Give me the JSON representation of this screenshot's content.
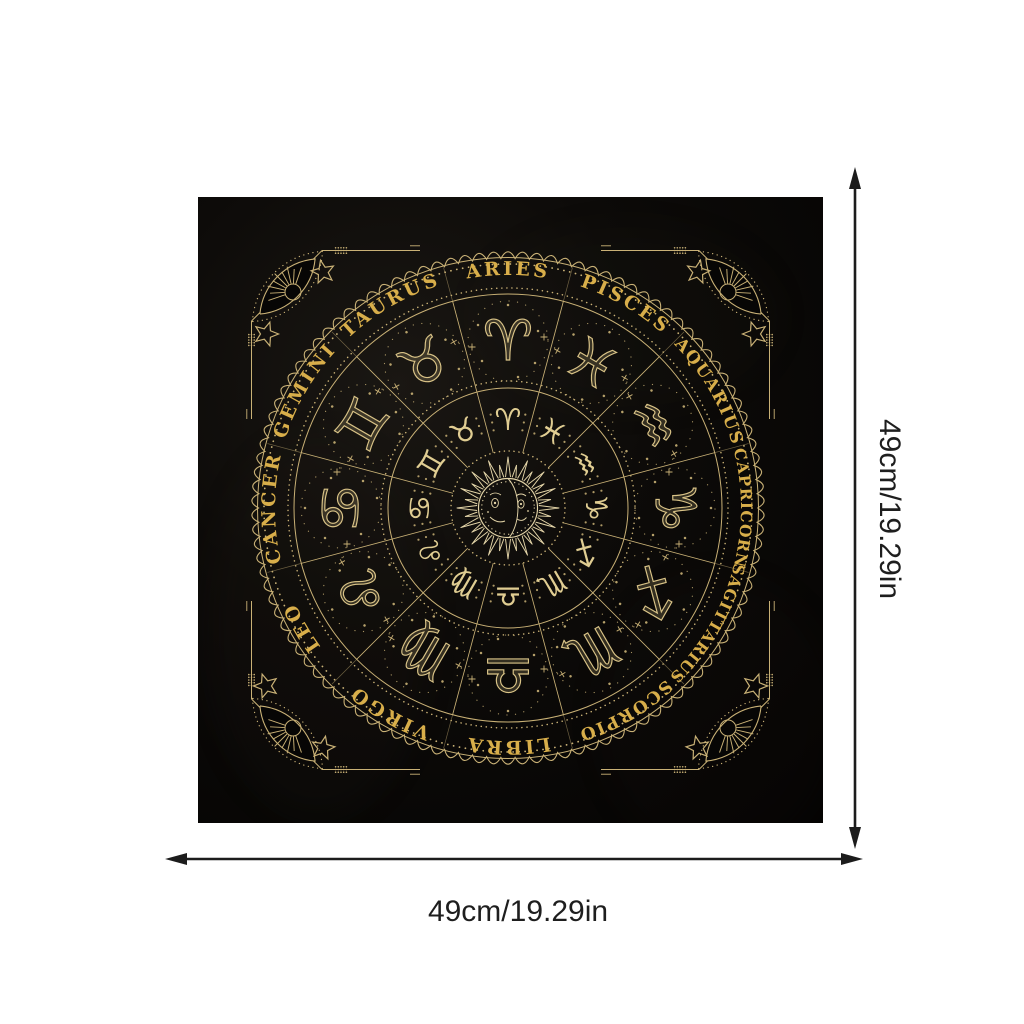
{
  "product": {
    "description": "black square altar cloth printed with a gold zodiac wheel"
  },
  "cloth": {
    "center_motif": "sun-moon-face",
    "corner_motif": "eye-with-sun-rays",
    "signs": [
      {
        "name": "ARIES",
        "glyph": "♈"
      },
      {
        "name": "PISCES",
        "glyph": "♓"
      },
      {
        "name": "AQUARIUS",
        "glyph": "♒"
      },
      {
        "name": "CAPRICORN",
        "glyph": "♑"
      },
      {
        "name": "SAGITTARIUS",
        "glyph": "♐"
      },
      {
        "name": "SCORPIO",
        "glyph": "♏"
      },
      {
        "name": "LIBRA",
        "glyph": "♎"
      },
      {
        "name": "VIRGO",
        "glyph": "♍"
      },
      {
        "name": "LEO",
        "glyph": "♌"
      },
      {
        "name": "CANCER",
        "glyph": "♋"
      },
      {
        "name": "GEMINI",
        "glyph": "♊"
      },
      {
        "name": "TAURUS",
        "glyph": "♉"
      }
    ],
    "colors": {
      "gold_line": "#c9b176",
      "gold_name": "#d8ae4a",
      "gold_pale": "#e4d5a8",
      "cloth_black": "#070605",
      "page_background": "#ffffff",
      "arrow_black": "#1c1c1c"
    }
  },
  "dimensions": {
    "width_label": "49cm/19.29in",
    "height_label": "49cm/19.29in"
  }
}
